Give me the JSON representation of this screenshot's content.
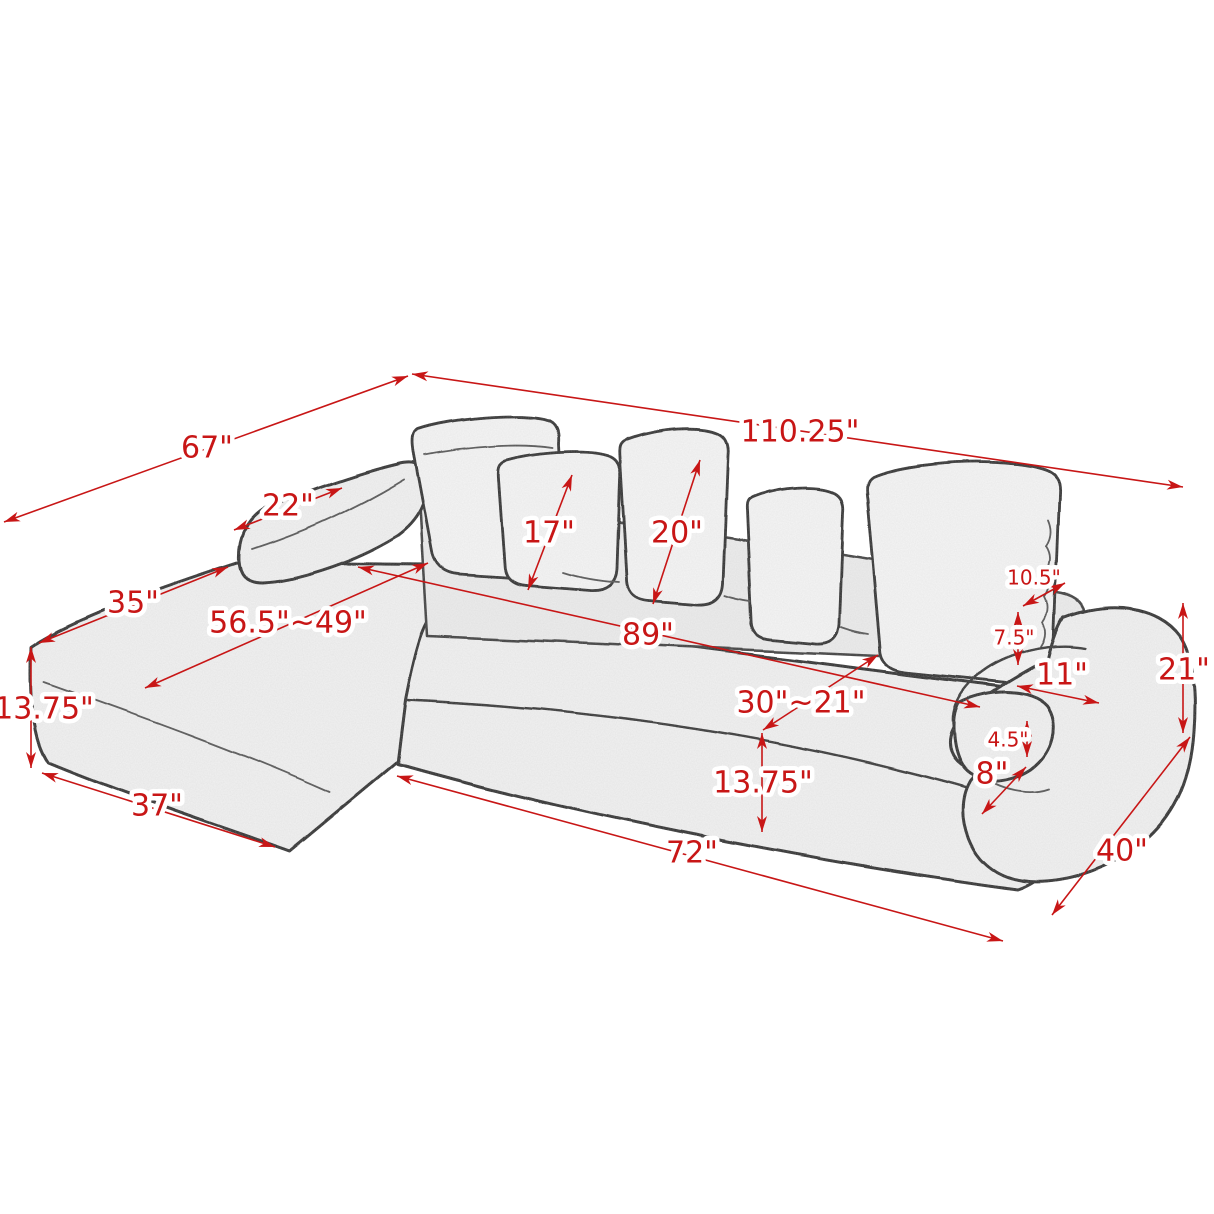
{
  "page": {
    "background": "#ffffff",
    "accent_red": "#c81616",
    "units": "inches"
  },
  "diagram": {
    "type": "sofa-dimension-diagram",
    "dimensions": [
      {
        "name": "overall-width",
        "label": "110.25\"",
        "line": [
          412,
          374,
          1183,
          487
        ],
        "label_pos": [
          800,
          433
        ],
        "size": 30
      },
      {
        "name": "overall-depth",
        "label": "67\"",
        "line": [
          408,
          376,
          4,
          522
        ],
        "label_pos": [
          207,
          449
        ],
        "size": 30
      },
      {
        "name": "left-arm-length",
        "label": "22\"",
        "line": [
          234,
          530,
          342,
          488
        ],
        "label_pos": [
          288,
          507
        ],
        "size": 30
      },
      {
        "name": "chaise-front-width",
        "label": "35\"",
        "line": [
          39,
          643,
          228,
          567
        ],
        "label_pos": [
          133,
          604
        ],
        "size": 30
      },
      {
        "name": "chaise-seat-depth",
        "label": "56.5\"~49\"",
        "line": [
          145,
          688,
          428,
          563
        ],
        "label_pos": [
          288,
          624
        ],
        "size": 30
      },
      {
        "name": "small-pillow-height",
        "label": "17\"",
        "line": [
          528,
          590,
          572,
          475
        ],
        "label_pos": [
          549,
          534
        ],
        "size": 30
      },
      {
        "name": "large-pillow-height",
        "label": "20\"",
        "line": [
          653,
          604,
          700,
          460
        ],
        "label_pos": [
          677,
          534
        ],
        "size": 30
      },
      {
        "name": "interior-seat-width",
        "label": "89\"",
        "line": [
          358,
          567,
          980,
          707
        ],
        "label_pos": [
          648,
          636
        ],
        "size": 30
      },
      {
        "name": "arm-top-depth",
        "label": "10.5\"",
        "line": [
          1023,
          606,
          1065,
          583
        ],
        "label_pos": [
          1034,
          579
        ],
        "size": 20
      },
      {
        "name": "backrest-above-arm",
        "label": "7.5\"",
        "line": [
          1018,
          612,
          1018,
          665
        ],
        "label_pos": [
          1014,
          639
        ],
        "size": 20
      },
      {
        "name": "right-arm-width",
        "label": "11\"",
        "line": [
          1017,
          686,
          1099,
          703
        ],
        "label_pos": [
          1062,
          676
        ],
        "size": 30
      },
      {
        "name": "back-height",
        "label": "21\"",
        "line": [
          1183,
          603,
          1183,
          733
        ],
        "label_pos": [
          1184,
          671
        ],
        "size": 30
      },
      {
        "name": "seat-depth-range",
        "label": "30\"~21\"",
        "line": [
          878,
          655,
          763,
          730
        ],
        "label_pos": [
          801,
          704
        ],
        "size": 30
      },
      {
        "name": "seat-height",
        "label": "13.75\"",
        "line": [
          762,
          733,
          762,
          832
        ],
        "label_pos": [
          763,
          784
        ],
        "size": 30
      },
      {
        "name": "arm-roll-height",
        "label": "4.5\"",
        "line": [
          1027,
          721,
          1027,
          757
        ],
        "label_pos": [
          1008,
          741
        ],
        "size": 20
      },
      {
        "name": "arm-roll-depth",
        "label": "8\"",
        "line": [
          1026,
          767,
          982,
          814
        ],
        "label_pos": [
          992,
          775
        ],
        "size": 30
      },
      {
        "name": "chaise-seat-height",
        "label": "13.75\"",
        "line": [
          31,
          647,
          31,
          768
        ],
        "label_pos": [
          44,
          710
        ],
        "size": 30
      },
      {
        "name": "chaise-bottom-width",
        "label": "37\"",
        "line": [
          42,
          773,
          275,
          847
        ],
        "label_pos": [
          157,
          807
        ],
        "size": 30
      },
      {
        "name": "sofa-bottom-width",
        "label": "72\"",
        "line": [
          397,
          776,
          1003,
          941
        ],
        "label_pos": [
          692,
          854
        ],
        "size": 30
      },
      {
        "name": "sofa-side-depth",
        "label": "40\"",
        "line": [
          1190,
          737,
          1052,
          915
        ],
        "label_pos": [
          1122,
          852
        ],
        "size": 30
      }
    ]
  }
}
